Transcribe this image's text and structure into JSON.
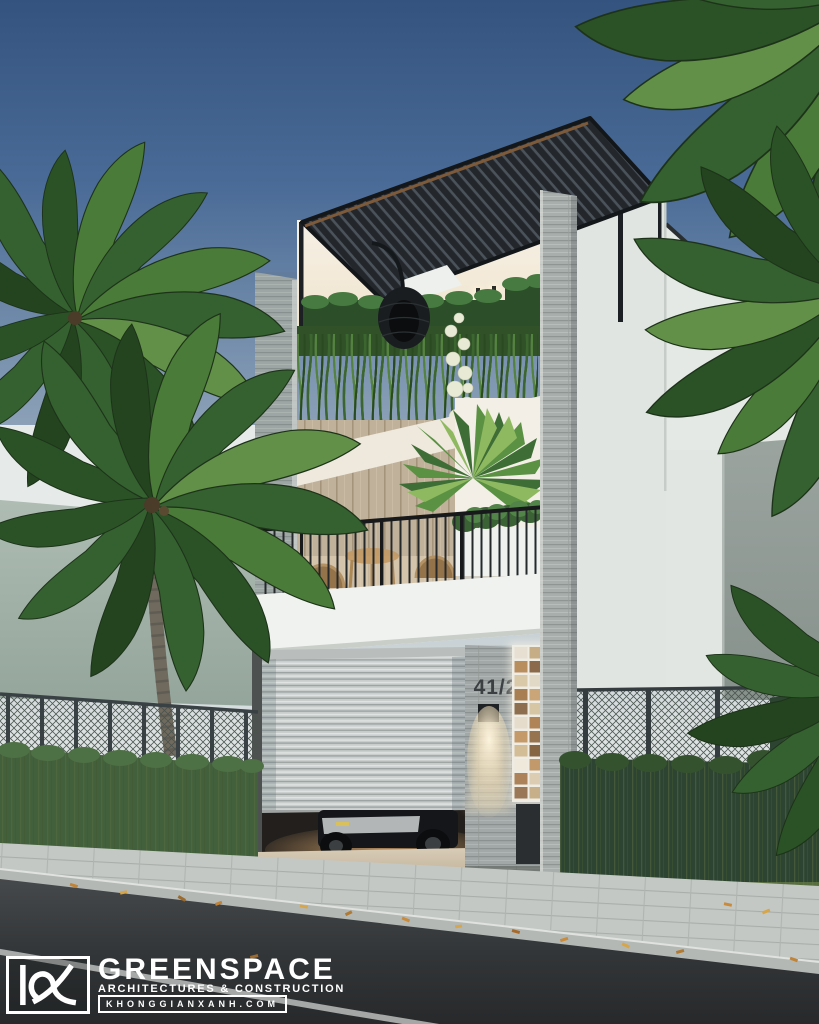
{
  "meta": {
    "description": "Photorealistic architectural rendering of a narrow modern three-storey tube house with a louvered rooftop pergola, cascading balcony greenery, a roller-shutter garage with a parked car, stone-clad piers, hedge fences, palm trees and a street in the foreground at dusk."
  },
  "house": {
    "number_plate": "41/2"
  },
  "branding": {
    "monogram": "KX",
    "name": "GREENSPACE",
    "tagline": "ARCHITECTURES & CONSTRUCTION",
    "website": "KHONGGIANXANH.COM"
  },
  "palette": {
    "sky_top": "#35537f",
    "sky_horizon": "#d8dfe0",
    "pergola_slats": "#23272c",
    "stone_cladding": "#a8aeac",
    "wall_white": "#eef0ec",
    "wall_green_gray": "#a3b2a9",
    "foliage_dark": "#24441f",
    "foliage_mid": "#356030",
    "hedge_dark": "#2c4431",
    "asphalt": "#313436",
    "sidewalk": "#c3c7c3",
    "warm_light": "#ffedc4",
    "tile_accent_tan": "#c49a6a"
  }
}
